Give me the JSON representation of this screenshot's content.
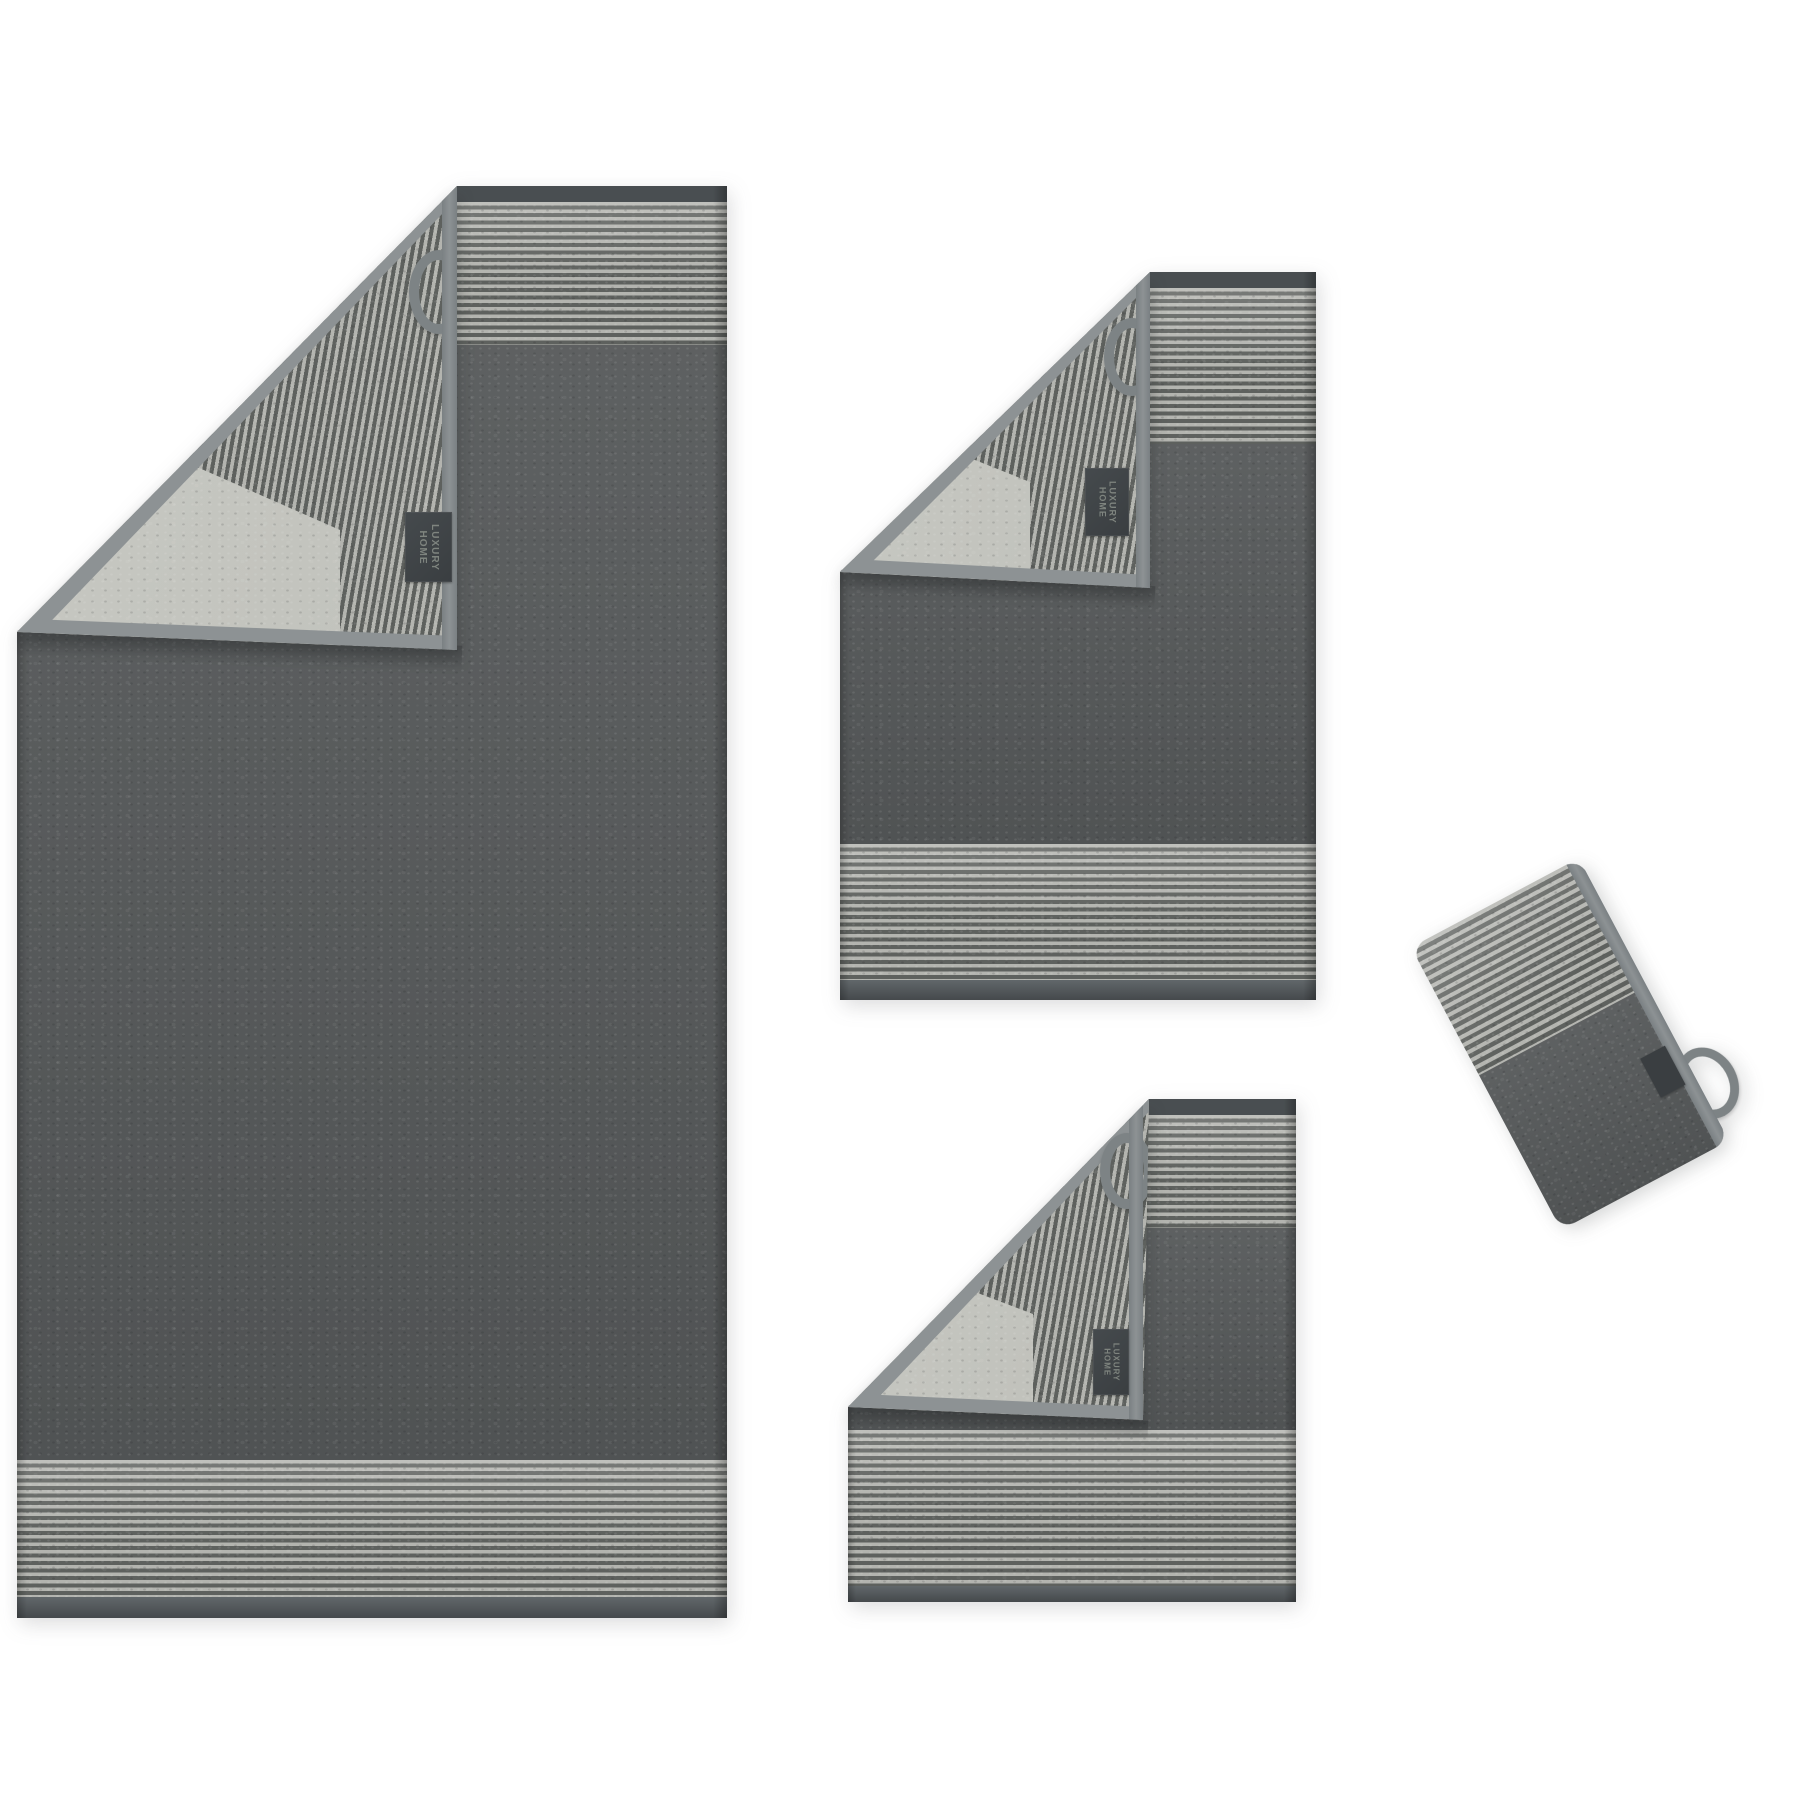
{
  "scene": {
    "type": "product-photo",
    "subject": "Two-tone grey terry towel set with striped borders and folded corners",
    "background_color": "#ffffff",
    "items": [
      {
        "id": "bath-towel",
        "label": "Bath towel, folded corner showing striped reverse, hanging loop and woven brand label"
      },
      {
        "id": "hand-towel",
        "label": "Hand towel, folded corner showing striped reverse, hanging loop and woven brand label"
      },
      {
        "id": "guest-towel",
        "label": "Guest towel, folded corner showing striped reverse, hanging loop and woven brand label"
      },
      {
        "id": "wash-mitt",
        "label": "Wash mitt, tilted, striped cuff half, hanging loop and small tag"
      }
    ]
  },
  "brand_label": {
    "line1": "LUXURY",
    "line2": "HOME"
  },
  "palette": {
    "background": "#ffffff",
    "body_dark": "#555859",
    "stripe_light": "#b3b4af",
    "stripe_dark": "#5e615e",
    "back_plain": "#b9bab4",
    "back_plain_light": "#c8c9c3",
    "binding": "#7a8083",
    "binding_light": "#8d9294",
    "hem_top": "#494e51",
    "hem_bottom": "#61676a",
    "edge_dark": "#45494c",
    "label_bg": "#3a3e41",
    "label_text": "#949a92",
    "loop": "#7d8385"
  }
}
